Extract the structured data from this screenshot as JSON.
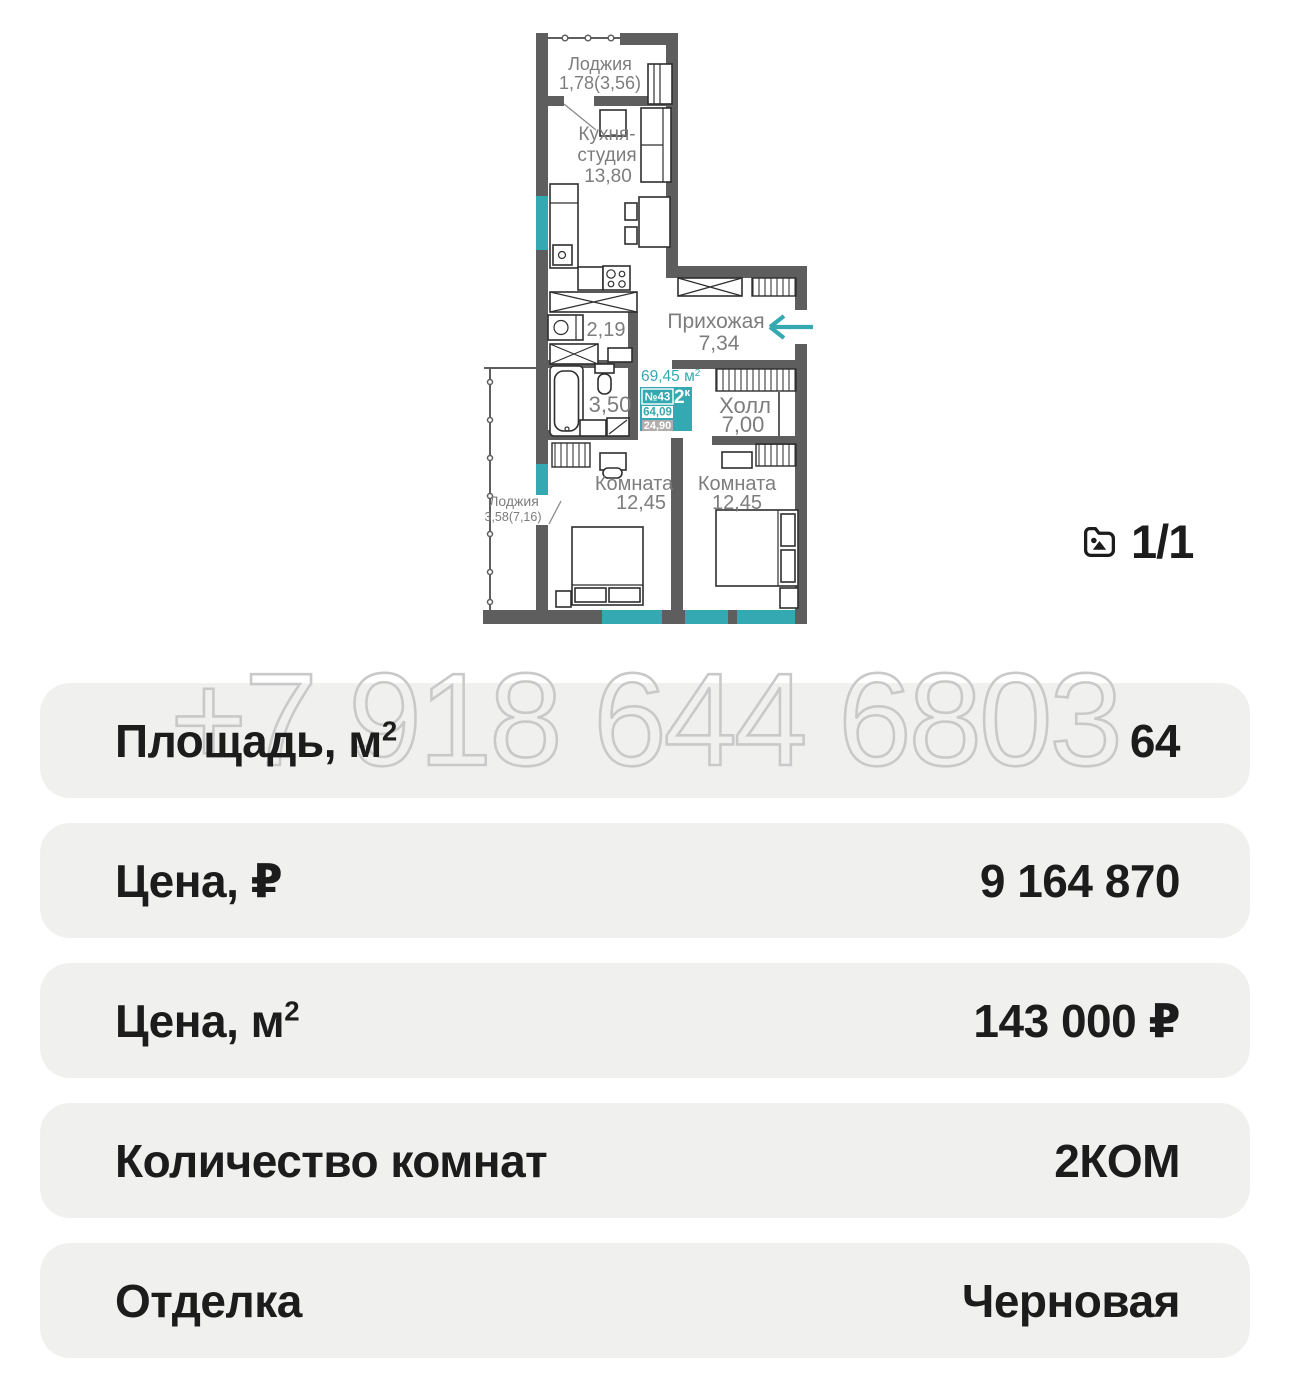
{
  "plan": {
    "rooms": {
      "loggia_top": {
        "name": "Лоджия",
        "area": "1,78(3,56)"
      },
      "kitchen": {
        "name_line1": "Кухня-",
        "name_line2": "студия",
        "area": "13,80"
      },
      "nook": {
        "area": "2,19"
      },
      "hallway": {
        "name": "Прихожая",
        "area": "7,34"
      },
      "bathroom": {
        "area": "3,50"
      },
      "hall": {
        "name": "Холл",
        "area": "7,00"
      },
      "bedroom_left": {
        "name": "Комната",
        "area": "12,45"
      },
      "bedroom_right": {
        "name": "Комната",
        "area": "12,45"
      },
      "loggia_left": {
        "name": "Лоджия",
        "area": "3,58(7,16)"
      }
    },
    "badge": {
      "total_area": "69,45 м",
      "total_area_sup": "2",
      "unit_number": "№43",
      "rooms_count": "2",
      "rooms_count_sup": "к",
      "area_value": "64,09",
      "living_area_value": "24,90"
    },
    "colors": {
      "teal": "#35a9b1",
      "wall": "#5e5e5e",
      "label": "#7d7d7d",
      "badge_gray": "#b0aead"
    }
  },
  "photo_counter": {
    "label": "1/1"
  },
  "watermark": {
    "text": "+7 918 644 6803"
  },
  "details": [
    {
      "label": "Площадь, м",
      "sup": "2",
      "value": "64"
    },
    {
      "label": "Цена, ₽",
      "sup": "",
      "value": "9 164 870"
    },
    {
      "label": "Цена, м",
      "sup": "2",
      "value": "143 000 ₽"
    },
    {
      "label": "Количество комнат",
      "sup": "",
      "value": "2КОМ"
    },
    {
      "label": "Отделка",
      "sup": "",
      "value": "Черновая"
    }
  ],
  "colors": {
    "row_bg": "#f0f0ef",
    "text": "#1c1c1c",
    "watermark_outline": "#c9c9c9"
  }
}
